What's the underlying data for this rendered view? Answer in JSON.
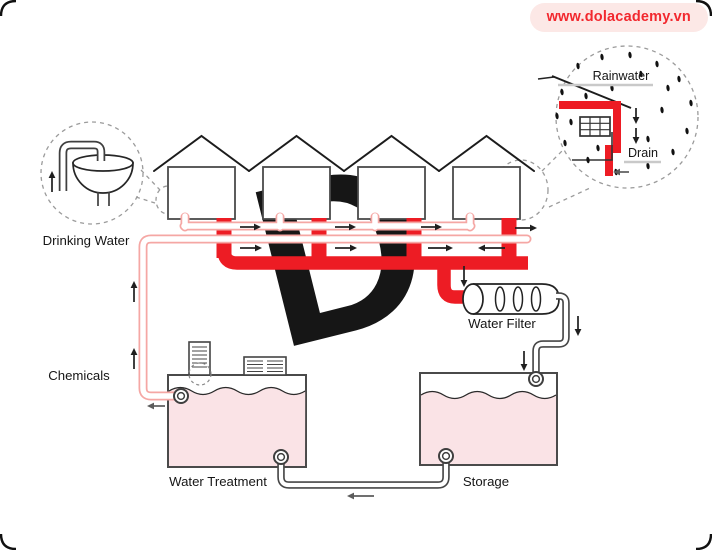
{
  "badge": {
    "text": "www.dolacademy.vn",
    "bg_color": "#fce8e6",
    "text_color": "#f2282e"
  },
  "labels": {
    "drinking_water": "Drinking Water",
    "chemicals": "Chemicals",
    "water_filter": "Water Filter",
    "water_treatment": "Water Treatment",
    "storage": "Storage",
    "rainwater": "Rainwater",
    "drain": "Drain"
  },
  "diagram": {
    "type": "rainwater-harvesting-and-water-treatment-schematic",
    "house_count": 4,
    "flows": [
      "rainwater collected from house roofs drains into red pipe network",
      "red drain main feeds Water Filter",
      "filtered water flows down into Storage tank",
      "storage transfers via bottom pipe to Water Treatment tank",
      "chemicals added at treatment; treated water rises in pink supply pipe back to houses as drinking water"
    ],
    "icons": [
      "faucet-sink-icon",
      "gutter-drain-icon",
      "rain-drop-icon",
      "water-filter-icon",
      "chimney-doser-icon",
      "vent-grille-icon",
      "flow-arrow-icon"
    ],
    "colors": {
      "drain_pipe_red": "#ed1c24",
      "supply_pipe_pink": "#f5a7a4",
      "tank_water_pink": "#fae3e6",
      "outline_dark": "#3f3f3f",
      "dashed_gray": "#9b9b9b",
      "underline_gray": "#c9c9c9",
      "watermark_pink": "#fbebed"
    }
  }
}
